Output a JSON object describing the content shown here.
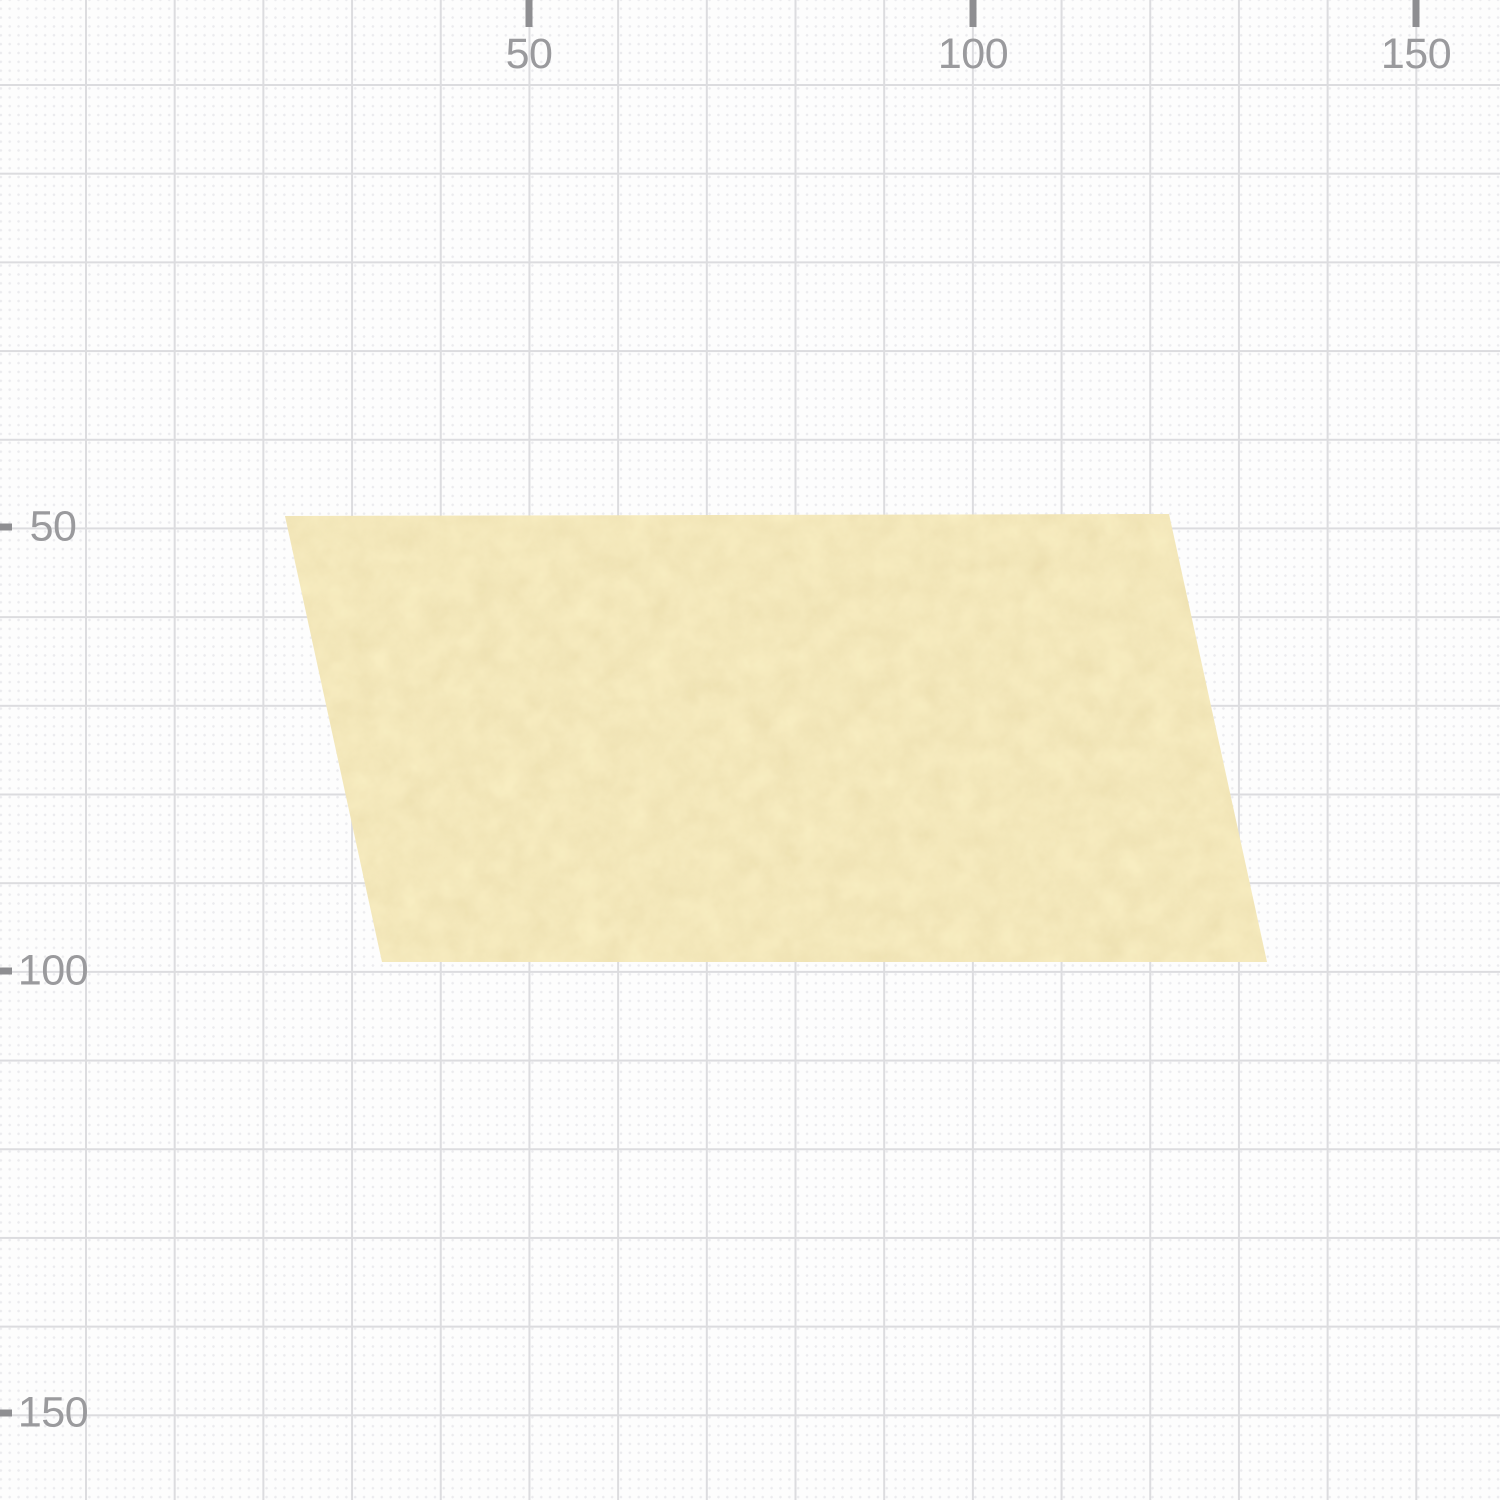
{
  "canvas": {
    "background_color": "#fdfdfd",
    "grid": {
      "major_line_color": "#dcdcdf",
      "minor_dot_color": "#ebebee",
      "major_spacing_px": 88.7,
      "minor_spacing_px": 8.87
    },
    "ruler": {
      "tick_color": "#8e8e91",
      "label_color": "#9a9a9d",
      "top_ticks": [
        {
          "label": "50",
          "x": 529
        },
        {
          "label": "100",
          "x": 973
        },
        {
          "label": "150",
          "x": 1416
        }
      ],
      "left_ticks": [
        {
          "label": "50",
          "y": 527
        },
        {
          "label": "100",
          "y": 971
        },
        {
          "label": "150",
          "y": 1413
        }
      ]
    }
  },
  "shape": {
    "kind": "parallelogram",
    "fill_color": "#f8edc1",
    "texture_color": "#d9c48c",
    "points": "285,516 1169,514 1267,962 382,962"
  }
}
